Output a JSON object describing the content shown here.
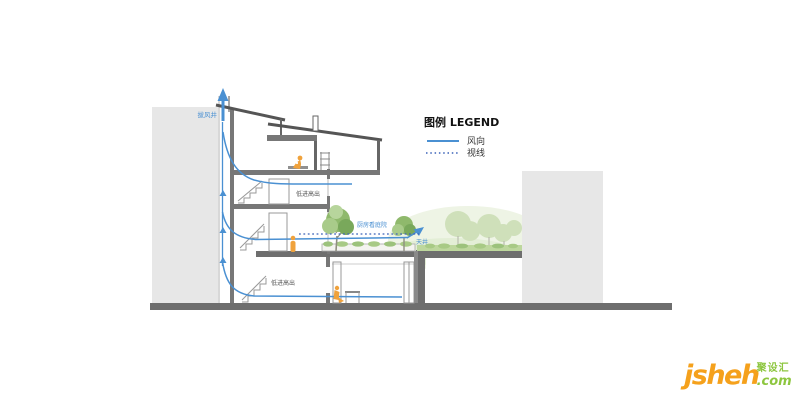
{
  "page": {
    "background": "#ffffff"
  },
  "legend": {
    "title": "图例 LEGEND",
    "items": [
      {
        "id": "wind",
        "label": "风向",
        "line_style": "solid",
        "color": "#4a90d2"
      },
      {
        "id": "sight",
        "label": "视线",
        "line_style": "dotted",
        "color": "#3a62b8"
      }
    ]
  },
  "annotations": {
    "wind_shaft": "拔风井",
    "upper_vent_note": "低进高出",
    "lower_vent_note": "低进高出",
    "kitchen_sightline": "厨房看庭院",
    "lightwell": "天井"
  },
  "watermark": {
    "brand": "jsheh",
    "tld": ".com",
    "brand_cn": "聚设汇"
  },
  "colors": {
    "wind_line": "#4a90d2",
    "sight_line": "#3a62b8",
    "neighbor_building": "#e7e7e7",
    "structure_dark": "#6e6e6e",
    "slab_gray": "#777777",
    "tree_green": "#8fb96c",
    "background_green": "#cfe0ba",
    "grass_green": "#bdd79d",
    "person_orange": "#f0a23c",
    "watermark_orange": "#f5a11c",
    "watermark_green": "#8dc63f",
    "label_dark": "#555555"
  }
}
